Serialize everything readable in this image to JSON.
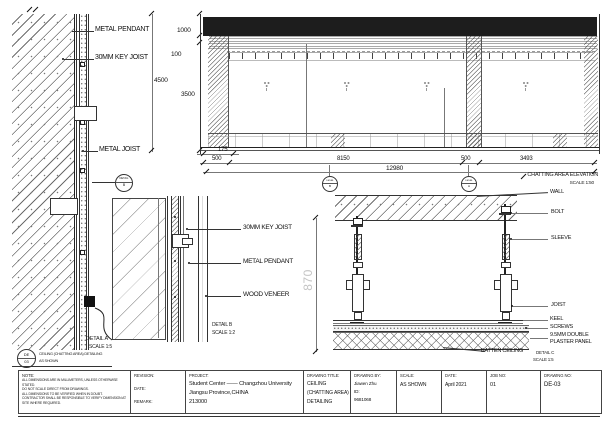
{
  "detail_a": {
    "label_metal_pendant": "METAL PENDANT",
    "label_key_joist": "30MM KEY JOIST",
    "label_metal_joist": "METAL JOIST",
    "caption_title": "DETAIL A",
    "caption_scale": "SCALE 1:5",
    "ref_bubble_top": "DETAIL",
    "ref_bubble_letter": "B"
  },
  "sheet_ref": {
    "code_top": "DE",
    "code_bottom": "03",
    "title": "CEILING (CHATTING AREA) DETAILING",
    "scale": "AS SHOWN"
  },
  "elevation": {
    "caption_title": "CHATTING AREA ELEVATION",
    "caption_scale": "SCALE 1:50",
    "dim_1000": "1000",
    "dim_100": "100",
    "dim_4500": "4500",
    "dim_3500": "3500",
    "dim_175": "175",
    "dim_500_left": "500",
    "dim_8150": "8150",
    "dim_500_right": "500",
    "dim_3493": "3493",
    "dim_total": "12980",
    "bubble_left_top": "DETAIL",
    "bubble_left_letter": "B",
    "bubble_right_top": "DETAIL",
    "bubble_right_letter": "A"
  },
  "detail_b": {
    "label_key_joist": "30MM KEY JOIST",
    "label_metal_pendant": "METAL PENDANT",
    "label_wood_veneer": "WOOD VENEER",
    "caption_title": "DETAIL B",
    "caption_scale": "SCALE 1:2"
  },
  "detail_c": {
    "dim_870": "870",
    "label_wall": "WALL",
    "label_bolt": "BOLT",
    "label_sleeve": "SLEEVE",
    "label_joist": "JOIST",
    "label_keel": "KEEL",
    "label_screws": "SCREWS",
    "label_plaster_1": "9.5MM DOUBLE",
    "label_plaster_2": "PLASTER PANEL",
    "label_batten": "BATTEN CEILING",
    "caption_title": "DETAIL C",
    "caption_scale": "SCALE 1:5"
  },
  "titleblock": {
    "note_heading": "NOTE:",
    "note_line1": "ALL DIMENSIONS ARE IN MILLIMETERS, UNLESS OTHERWISE STATED.",
    "note_line2": "DO NOT SCALE DIRECT FROM DRAWINGS.",
    "note_line3": "ALL DIMENSIONS TO BE VERIFIED WHEN IN DOUBT.",
    "note_line4": "CONTRACTOR SHALL BE RESPONSIBLE TO VERIFY DIMENSION AT SITE WHERE REQUIRED.",
    "revision_label": "REVISION:",
    "date_label_small": "DATE:",
    "remark_label": "REMARK:",
    "project_heading": "PROJECT:",
    "project_line1": "Student Center —— Changzhou University",
    "project_line2": "Jiangsu Province,CHINA",
    "project_line3": "213000",
    "drawing_title_heading": "DRAWING TITLE:",
    "drawing_title_line1": "CEILING",
    "drawing_title_line2": "(CHATTING AREA)",
    "drawing_title_line3": "DETAILING",
    "drawing_by_heading": "DRAWING BY:",
    "drawing_by_name": "Jiawen Zhu",
    "drawing_by_id_label": "ID:",
    "drawing_by_id": "9681068",
    "scale_heading": "SCALE:",
    "scale_value": "AS SHOWN",
    "date_heading": "DATE:",
    "date_value": "April 2021",
    "job_heading": "JOB NO:",
    "job_value": "01",
    "dwg_heading": "DRAWING NO:",
    "dwg_value": "DE-03"
  }
}
